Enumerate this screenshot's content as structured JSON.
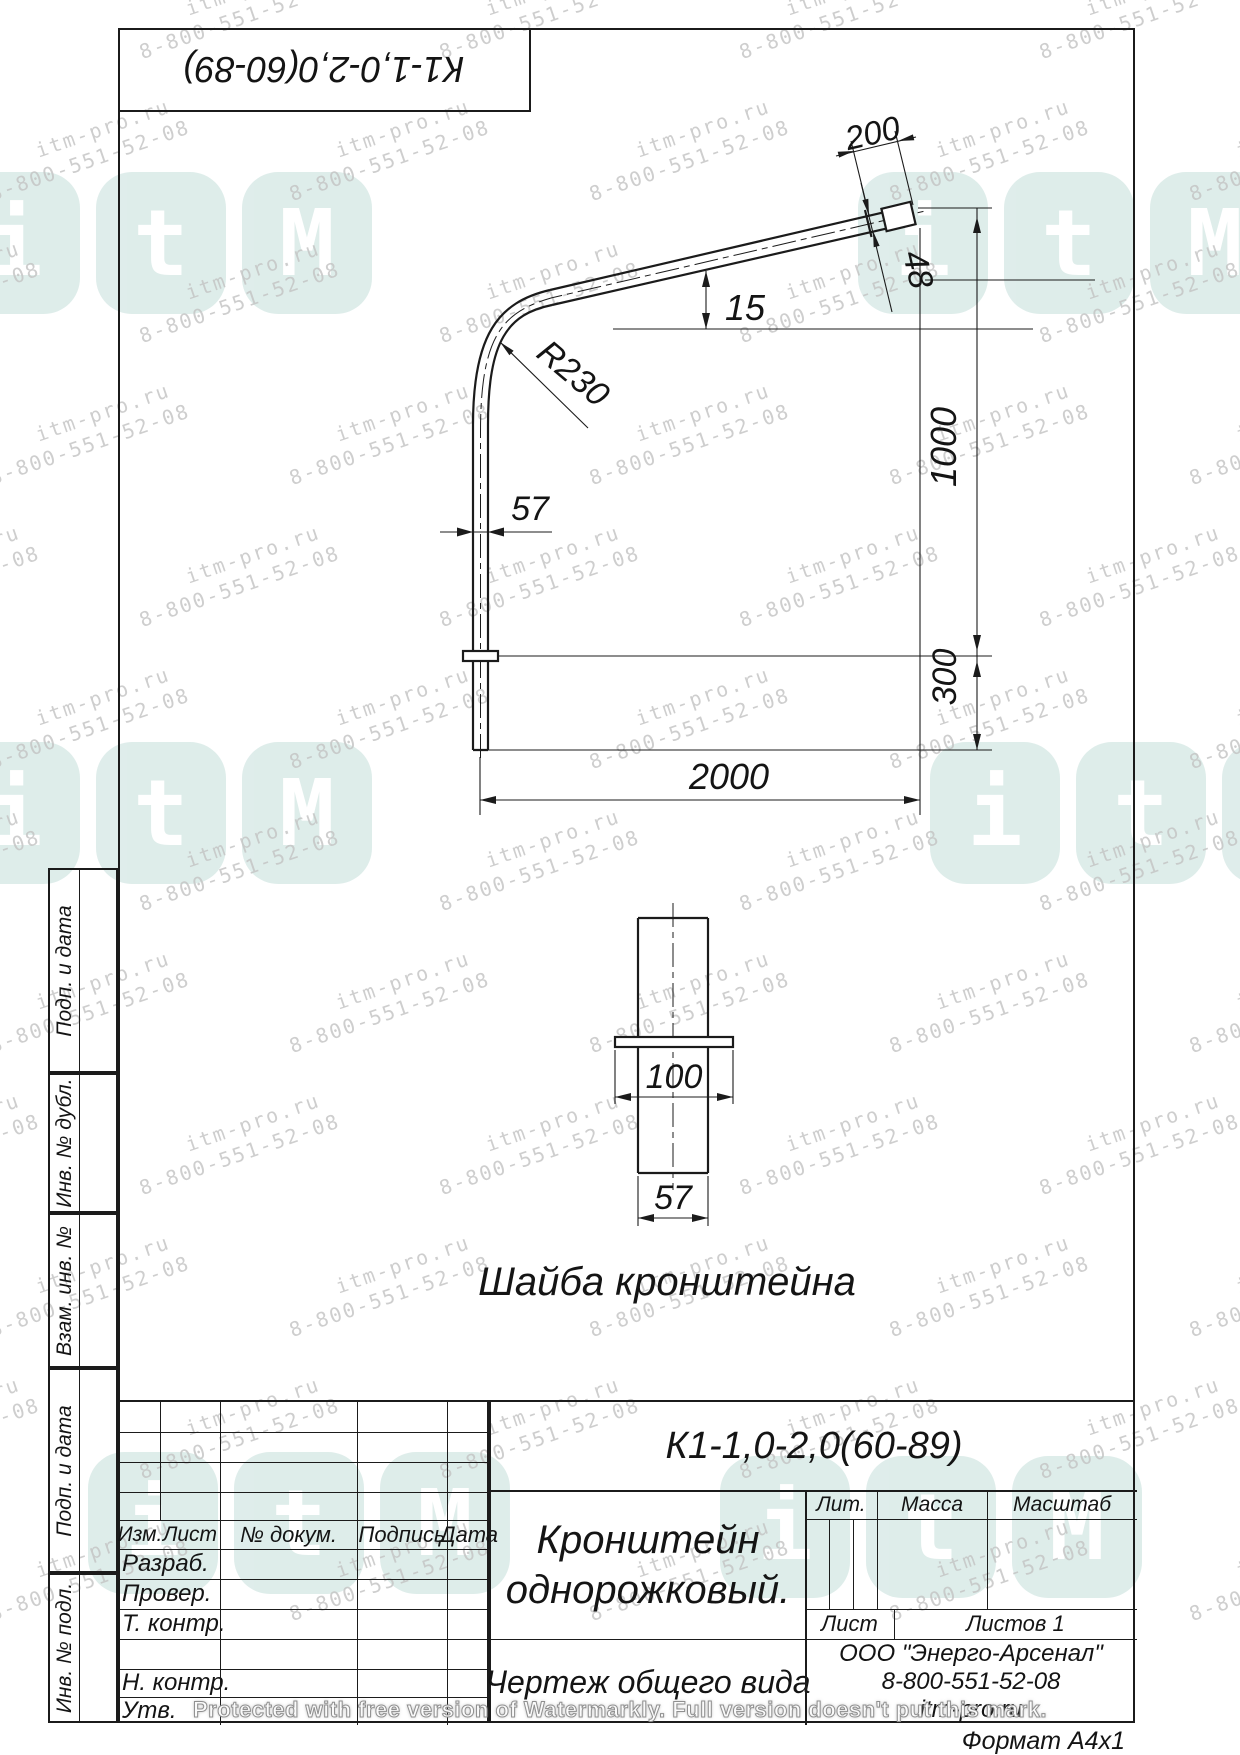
{
  "stamp_top": "К1-1,0-2,0(60-89)",
  "watermark": {
    "line1": "itm-pro.ru",
    "line2": "8-800-551-52-08",
    "logo_letters": [
      "i",
      "t",
      "M"
    ],
    "protect_text": "Protected with free version of Watermarkly. Full version doesn't put this mark."
  },
  "drawing": {
    "dims": {
      "d200": "200",
      "d48": "48",
      "d15": "15",
      "r230": "R230",
      "d57": "57",
      "d1000": "1000",
      "d300": "300",
      "d2000": "2000",
      "w100": "100",
      "w57": "57"
    },
    "washer_caption": "Шайба кронштейна"
  },
  "title_block": {
    "designation": "К1-1,0-2,0(60-89)",
    "name_line1": "Кронштейн",
    "name_line2": "однорожковый.",
    "doc_type": "Чертеж общего вида",
    "lit": "Лит.",
    "massa": "Масса",
    "masshtab": "Масштаб",
    "list": "Лист",
    "listov": "Листов 1",
    "company": "ООО \"Энерго-Арсенал\"",
    "phone": "8-800-551-52-08",
    "site": "itm-pro.ru",
    "format": "Формат  А4х1"
  },
  "rev_table": {
    "izm": "Изм.",
    "list": "Лист",
    "n_dokum": "№ докум.",
    "podpis": "Подпись",
    "data": "Дата",
    "razrab": "Разраб.",
    "prover": "Провер.",
    "t_kontr": "Т. контр.",
    "n_kontr": "Н. контр.",
    "utv": "Утв."
  },
  "side_labels": [
    "Подп. и дата",
    "Инв. № дубл.",
    "Взам. инв. №",
    "Подп. и дата",
    "Инв. № подл."
  ]
}
